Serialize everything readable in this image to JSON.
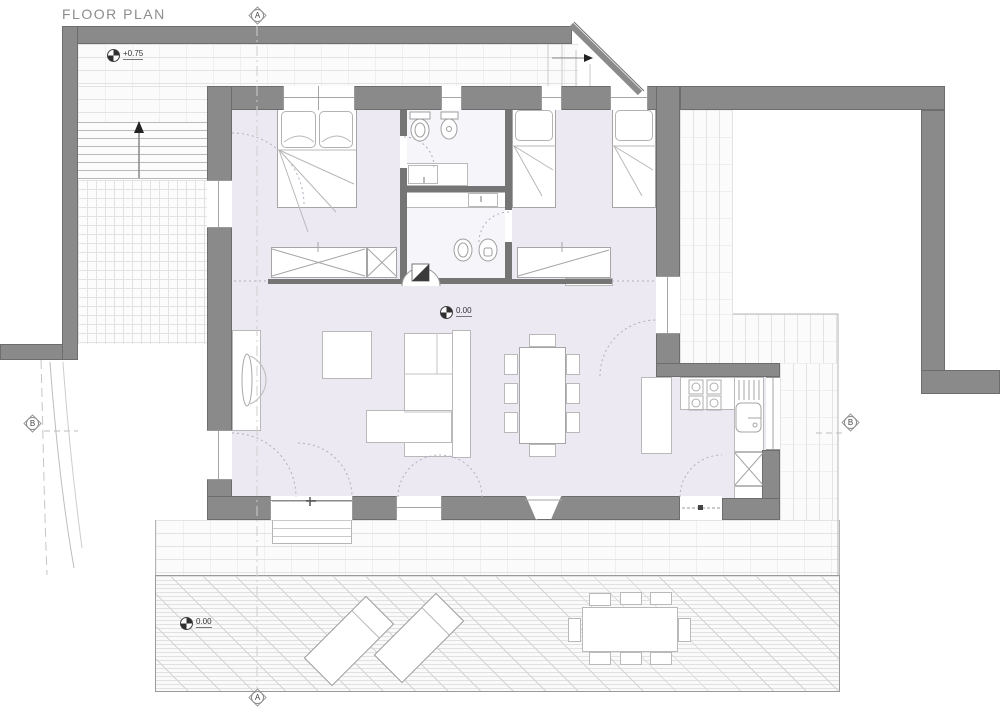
{
  "title": "FLOOR PLAN",
  "levels": {
    "upper_terrace": "+0.75",
    "interior": "0.00",
    "lower_terrace": "0.00"
  },
  "sections": {
    "top": "A",
    "bottom": "A",
    "left": "B",
    "right": "B"
  },
  "colors": {
    "wall": "#8a8a8a",
    "interior_wall": "#757575",
    "interior_floor": "#ece9f2",
    "hatch_line": "#e3e3e3",
    "annotation": "#333333",
    "background": "#ffffff"
  }
}
